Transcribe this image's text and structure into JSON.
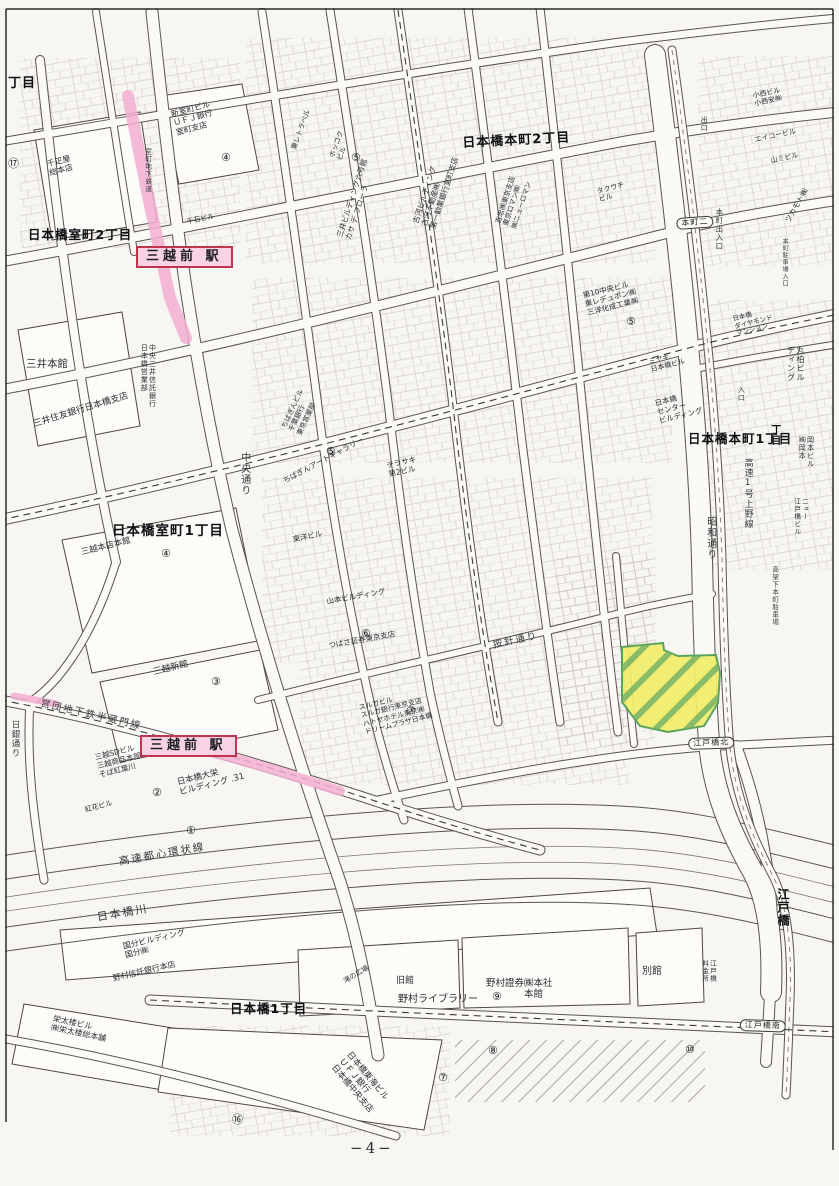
{
  "page": {
    "number": "−4−"
  },
  "colors": {
    "highlight_pink": "#f2aed2",
    "station_red": "#c2344d",
    "station_bg": "#f9d3e4",
    "parcel_fill": "#f2ee6a",
    "parcel_stroke": "#4e9e52",
    "parcel_hatch": "#6fae66"
  },
  "map": {
    "parcel": {
      "points": "622,647 663,643 664,650 678,656 716,655 720,673 718,703 704,726 668,732 640,726 622,702"
    },
    "pink_segments": [
      {
        "points": "128,96 148,196 170,298 186,338"
      },
      {
        "points": "204,750 268,768 340,791"
      },
      {
        "points": "14,696 56,704"
      }
    ],
    "labels": [
      {
        "name": "label-chome-fragment",
        "text": "丁目",
        "x": 8,
        "y": 76,
        "rot": 0,
        "fs": 13,
        "cls": "area"
      },
      {
        "name": "label-muromachi-2chome",
        "text": "日本橋室町2丁目",
        "x": 28,
        "y": 228,
        "rot": 0,
        "fs": 12.5,
        "cls": "area"
      },
      {
        "name": "label-honcho-2chome",
        "text": "日本橋本町2丁目",
        "x": 462,
        "y": 136,
        "rot": -3,
        "fs": 13,
        "cls": "area"
      },
      {
        "name": "label-muromachi-1chome",
        "text": "日本橋室町1丁目",
        "x": 112,
        "y": 524,
        "rot": 0,
        "fs": 13.5,
        "cls": "area"
      },
      {
        "name": "label-honcho-1chome",
        "text": "日本橋本町1丁目",
        "x": 688,
        "y": 432,
        "rot": 0,
        "fs": 12.5,
        "cls": "area"
      },
      {
        "name": "label-nihonbashi-1chome",
        "text": "日本橋1丁目",
        "x": 230,
        "y": 1002,
        "rot": 0,
        "fs": 12.5,
        "cls": "area"
      },
      {
        "name": "label-edobashi",
        "text": "江戸橋",
        "x": 776,
        "y": 888,
        "rot": 0,
        "fs": 12,
        "cls": "area vert"
      },
      {
        "name": "label-chome-right-edge",
        "text": "丁目",
        "x": 768,
        "y": 424,
        "rot": 0,
        "fs": 10,
        "cls": "area vert"
      },
      {
        "name": "station-box-mitsukoshimae-north",
        "text": "三越前 駅",
        "x": 136,
        "y": 246,
        "rot": 0,
        "fs": 13,
        "cls": "station"
      },
      {
        "name": "station-box-mitsukoshimae-south",
        "text": "三越前 駅",
        "x": 140,
        "y": 735,
        "rot": 0,
        "fs": 13,
        "cls": "station"
      },
      {
        "name": "road-label-chuo-dori",
        "text": "中央通り",
        "x": 238,
        "y": 452,
        "rot": 0,
        "fs": 10,
        "cls": "street vert"
      },
      {
        "name": "road-label-showa-dori",
        "text": "昭和通り",
        "x": 704,
        "y": 516,
        "rot": 0,
        "fs": 10,
        "cls": "street vert"
      },
      {
        "name": "road-label-kosoku-1-ueno",
        "text": "高速1号上野線",
        "x": 742,
        "y": 458,
        "rot": 0,
        "fs": 9,
        "cls": "street vert"
      },
      {
        "name": "road-label-kokashita-parking",
        "text": "高架下本町駐車場",
        "x": 770,
        "y": 566,
        "rot": 0,
        "fs": 6.5,
        "cls": "street vert"
      },
      {
        "name": "road-label-anjin-dori",
        "text": "按針通り",
        "x": 492,
        "y": 640,
        "rot": -12,
        "fs": 9.5,
        "cls": "street"
      },
      {
        "name": "road-label-hanzomon-line",
        "text": "営団地下鉄半蔵門線",
        "x": 42,
        "y": 698,
        "rot": 13,
        "fs": 9.5,
        "cls": "street"
      },
      {
        "name": "road-label-toshin-kanjo",
        "text": "高速都心環状線",
        "x": 118,
        "y": 856,
        "rot": -10,
        "fs": 10.5,
        "cls": "street"
      },
      {
        "name": "river-label-nihonbashigawa",
        "text": "日本橋川",
        "x": 96,
        "y": 912,
        "rot": -10,
        "fs": 11,
        "cls": "street"
      },
      {
        "name": "road-label-nichigin-dori",
        "text": "日銀通り",
        "x": 10,
        "y": 720,
        "rot": 0,
        "fs": 8.5,
        "cls": "street vert"
      },
      {
        "name": "road-label-honcho-deiriguchi",
        "text": "本町出入口",
        "x": 714,
        "y": 208,
        "rot": 0,
        "fs": 7.5,
        "cls": "street vert"
      },
      {
        "name": "road-label-honcho-parking-entrance",
        "text": "本町駐車場入口",
        "x": 781,
        "y": 238,
        "rot": 0,
        "fs": 6,
        "cls": "street vert"
      },
      {
        "name": "road-label-deguchi",
        "text": "出口",
        "x": 700,
        "y": 116,
        "rot": 0,
        "fs": 7,
        "cls": "street vert"
      },
      {
        "name": "road-label-iriguchi",
        "text": "入口",
        "x": 737,
        "y": 386,
        "rot": 0,
        "fs": 7,
        "cls": "street vert"
      },
      {
        "name": "road-label-muromachi-chika",
        "text": "室町地下鉄道",
        "x": 143,
        "y": 148,
        "rot": 0,
        "fs": 6.5,
        "cls": "street vert"
      },
      {
        "name": "oval-honcho-2",
        "text": "本町二",
        "x": 676,
        "y": 218,
        "rot": -4,
        "fs": 8,
        "cls": "oval"
      },
      {
        "name": "oval-edobashi-kita",
        "text": "江戸橋北",
        "x": 688,
        "y": 738,
        "rot": -2,
        "fs": 8,
        "cls": "oval"
      },
      {
        "name": "oval-edobashi-minami",
        "text": "江戸橋南",
        "x": 740,
        "y": 1019,
        "rot": 2,
        "fs": 8,
        "cls": "oval"
      },
      {
        "name": "bldg-shinmuromachi-ufj",
        "text": "新室町ビル\nＵＦＪ銀行\n室町支店",
        "x": 170,
        "y": 110,
        "rot": -15,
        "fs": 8,
        "cls": "bldg"
      },
      {
        "name": "bldg-sembikiya",
        "text": "千疋屋\n総本店",
        "x": 46,
        "y": 160,
        "rot": -15,
        "fs": 8,
        "cls": "bldg"
      },
      {
        "name": "bldg-sengoku",
        "text": "千石ビル",
        "x": 186,
        "y": 218,
        "rot": -12,
        "fs": 7,
        "cls": "bldg"
      },
      {
        "name": "bldg-hokkoku",
        "text": "ホッコク\nビル",
        "x": 328,
        "y": 156,
        "rot": -70,
        "fs": 7,
        "cls": "bldg"
      },
      {
        "name": "bldg-toray-travel",
        "text": "東レトラベル",
        "x": 290,
        "y": 148,
        "rot": -70,
        "fs": 7,
        "cls": "bldg"
      },
      {
        "name": "bldg-mitsui-6-casa",
        "text": "三井ビルディング六号館\nカサ デ フローラ",
        "x": 336,
        "y": 236,
        "rot": -72,
        "fs": 7.5,
        "cls": "bldg"
      },
      {
        "name": "bldg-furukawa",
        "text": "古河ビルディング\n古河不動産㈱\n第一勧業銀行室町支店",
        "x": 412,
        "y": 222,
        "rot": -72,
        "fs": 7.5,
        "cls": "bldg"
      },
      {
        "name": "bldg-yoshichu",
        "text": "吉忠㈱東京支店\n東京ロマン㈱\n㈱ニューロマン",
        "x": 494,
        "y": 222,
        "rot": -72,
        "fs": 7,
        "cls": "bldg"
      },
      {
        "name": "bldg-takeuchi",
        "text": "タクウチ\nビル",
        "x": 596,
        "y": 188,
        "rot": -15,
        "fs": 7,
        "cls": "bldg"
      },
      {
        "name": "bldg-konishi",
        "text": "小西ビル\n小西安㈱",
        "x": 752,
        "y": 92,
        "rot": -12,
        "fs": 7,
        "cls": "bldg"
      },
      {
        "name": "bldg-eiko",
        "text": "エイコービル",
        "x": 754,
        "y": 136,
        "rot": -12,
        "fs": 7,
        "cls": "bldg"
      },
      {
        "name": "bldg-yamami",
        "text": "山ミビル",
        "x": 770,
        "y": 157,
        "rot": -12,
        "fs": 7,
        "cls": "bldg"
      },
      {
        "name": "bldg-tsukamoto",
        "text": "ツカモト㈱",
        "x": 784,
        "y": 220,
        "rot": -60,
        "fs": 7.5,
        "cls": "bldg"
      },
      {
        "name": "bldg-mitsui-honkan",
        "text": "三井本館",
        "x": 26,
        "y": 358,
        "rot": 0,
        "fs": 10.5,
        "cls": "bldg"
      },
      {
        "name": "bldg-smbc-nihonbashi",
        "text": "三井住友銀行日本橋支店",
        "x": 32,
        "y": 420,
        "rot": -17,
        "fs": 9,
        "cls": "bldg"
      },
      {
        "name": "bldg-chuo-mitsui",
        "text": "中央三井信託銀行\n日本橋営業部",
        "x": 140,
        "y": 344,
        "rot": 0,
        "fs": 7,
        "cls": "bldg vert"
      },
      {
        "name": "bldg-chibagin",
        "text": "ちばぎんビル\n千葉銀行\n東京営業部",
        "x": 280,
        "y": 426,
        "rot": -65,
        "fs": 7,
        "cls": "bldg"
      },
      {
        "name": "bldg-chibagin-art",
        "text": "ちばぎんアートギャラリー",
        "x": 282,
        "y": 478,
        "rot": -28,
        "fs": 7.5,
        "cls": "bldg"
      },
      {
        "name": "bldg-terasaki",
        "text": "テラサキ\n第2ビル",
        "x": 386,
        "y": 462,
        "rot": -12,
        "fs": 7.5,
        "cls": "bldg"
      },
      {
        "name": "bldg-toyo",
        "text": "東洋ビル",
        "x": 292,
        "y": 536,
        "rot": -12,
        "fs": 7.5,
        "cls": "bldg"
      },
      {
        "name": "bldg-yamamoto",
        "text": "山本ビルディング",
        "x": 326,
        "y": 598,
        "rot": -10,
        "fs": 7.5,
        "cls": "bldg"
      },
      {
        "name": "bldg-tsubasa",
        "text": "つばさ証券東京支店",
        "x": 328,
        "y": 642,
        "rot": -10,
        "fs": 7.5,
        "cls": "bldg"
      },
      {
        "name": "bldg-mitsukoshi-honten",
        "text": "三越本店本館",
        "x": 80,
        "y": 548,
        "rot": -14,
        "fs": 8.5,
        "cls": "bldg"
      },
      {
        "name": "bldg-mitsukoshi-shinkan",
        "text": "三越新館",
        "x": 152,
        "y": 668,
        "rot": -14,
        "fs": 9,
        "cls": "bldg"
      },
      {
        "name": "bldg-suruga",
        "text": "スルガビル\nスルガ銀行東京支店\nハトヤホテル東京㈱\nドリームプラザ日本橋",
        "x": 358,
        "y": 704,
        "rot": -14,
        "fs": 7,
        "cls": "bldg"
      },
      {
        "name": "bldg-dai10-chuo",
        "text": "第10中央ビル\n東レデュポン㈱\n三洋化成工業㈱",
        "x": 582,
        "y": 292,
        "rot": -14,
        "fs": 7.5,
        "cls": "bldg"
      },
      {
        "name": "bldg-miyagi",
        "text": "ミヤギ\n日本橋ビル",
        "x": 648,
        "y": 358,
        "rot": -14,
        "fs": 7,
        "cls": "bldg"
      },
      {
        "name": "bldg-nihonbashi-center",
        "text": "日本橋\nセンター\nビルディング",
        "x": 654,
        "y": 400,
        "rot": -14,
        "fs": 7.5,
        "cls": "bldg"
      },
      {
        "name": "bldg-marukashiwa",
        "text": "丸柏ビル\nディング",
        "x": 786,
        "y": 346,
        "rot": 0,
        "fs": 8,
        "cls": "bldg vert"
      },
      {
        "name": "bldg-diamond-mansion",
        "text": "日本橋\nダイヤモンド\nマンション",
        "x": 732,
        "y": 316,
        "rot": -14,
        "fs": 6.5,
        "cls": "bldg"
      },
      {
        "name": "bldg-okamoto",
        "text": "岡本ビル\n㈱岡本",
        "x": 798,
        "y": 436,
        "rot": 0,
        "fs": 7,
        "cls": "bldg vert"
      },
      {
        "name": "bldg-new-edobashi",
        "text": "ニュー\n江戸橋ビル",
        "x": 792,
        "y": 498,
        "rot": 0,
        "fs": 6.5,
        "cls": "bldg vert"
      },
      {
        "name": "bldg-mitsukoshi-sd",
        "text": "三越SDビル\n三越商品本部\nそば紅葉川",
        "x": 94,
        "y": 754,
        "rot": -14,
        "fs": 7.5,
        "cls": "bldg"
      },
      {
        "name": "bldg-daiei",
        "text": "日本橋大栄\nビルディング .31",
        "x": 176,
        "y": 778,
        "rot": -14,
        "fs": 8.5,
        "cls": "bldg"
      },
      {
        "name": "bldg-benibana",
        "text": "紅花ビル",
        "x": 84,
        "y": 806,
        "rot": -14,
        "fs": 7,
        "cls": "bldg"
      },
      {
        "name": "bldg-kokubu",
        "text": "国分ビルディング\n国分㈱",
        "x": 122,
        "y": 942,
        "rot": -13,
        "fs": 8,
        "cls": "bldg"
      },
      {
        "name": "bldg-nomura-trust",
        "text": "野村信託銀行本店",
        "x": 112,
        "y": 974,
        "rot": -13,
        "fs": 8,
        "cls": "bldg"
      },
      {
        "name": "bldg-eitaro",
        "text": "栄太楼ビル\n㈱栄太楼総本舗",
        "x": 54,
        "y": 1014,
        "rot": 12,
        "fs": 8,
        "cls": "bldg"
      },
      {
        "name": "plaza-taki",
        "text": "滝の広場",
        "x": 342,
        "y": 978,
        "rot": -30,
        "fs": 7,
        "cls": "bldg"
      },
      {
        "name": "bldg-kyukan",
        "text": "旧館",
        "x": 396,
        "y": 976,
        "rot": 0,
        "fs": 9,
        "cls": "bldg"
      },
      {
        "name": "bldg-nomura-library",
        "text": "野村ライブラリー",
        "x": 398,
        "y": 994,
        "rot": 0,
        "fs": 10,
        "cls": "bldg"
      },
      {
        "name": "bldg-nomura-honsha",
        "text": "野村證券㈱本社\n　　　　本館",
        "x": 486,
        "y": 978,
        "rot": 0,
        "fs": 9.5,
        "cls": "bldg"
      },
      {
        "name": "bldg-bekkan",
        "text": "別館",
        "x": 642,
        "y": 966,
        "rot": 0,
        "fs": 10,
        "cls": "bldg"
      },
      {
        "name": "tollgate-edobashi",
        "text": "江戸橋\n料金所",
        "x": 700,
        "y": 960,
        "rot": 0,
        "fs": 6.5,
        "cls": "bldg vert"
      },
      {
        "name": "bldg-ufj-chuo-branch",
        "text": "日本橋東海ビル\nＵＦＪ銀行\n日本橋中央支店",
        "x": 352,
        "y": 1050,
        "rot": 50,
        "fs": 8.5,
        "cls": "bldg"
      },
      {
        "name": "circled-17",
        "text": "⑰",
        "x": 8,
        "y": 158,
        "rot": 0,
        "fs": 11,
        "cls": "circ"
      },
      {
        "name": "circled-4a",
        "text": "④",
        "x": 221,
        "y": 152,
        "rot": 0,
        "fs": 11,
        "cls": "circ"
      },
      {
        "name": "circled-5a",
        "text": "⑤",
        "x": 351,
        "y": 152,
        "rot": 0,
        "fs": 11,
        "cls": "circ"
      },
      {
        "name": "circled-4b",
        "text": "④",
        "x": 161,
        "y": 548,
        "rot": 0,
        "fs": 11,
        "cls": "circ"
      },
      {
        "name": "circled-3",
        "text": "③",
        "x": 211,
        "y": 676,
        "rot": 0,
        "fs": 11,
        "cls": "circ"
      },
      {
        "name": "circled-5b",
        "text": "⑤",
        "x": 326,
        "y": 446,
        "rot": 0,
        "fs": 11,
        "cls": "circ"
      },
      {
        "name": "circled-5c",
        "text": "⑤",
        "x": 626,
        "y": 316,
        "rot": 0,
        "fs": 11,
        "cls": "circ"
      },
      {
        "name": "circled-6",
        "text": "⑥",
        "x": 361,
        "y": 628,
        "rot": 0,
        "fs": 11,
        "cls": "circ"
      },
      {
        "name": "circled-7",
        "text": "⑦",
        "x": 406,
        "y": 705,
        "rot": 0,
        "fs": 11,
        "cls": "circ"
      },
      {
        "name": "circled-2",
        "text": "②",
        "x": 152,
        "y": 787,
        "rot": 0,
        "fs": 11,
        "cls": "circ"
      },
      {
        "name": "circled-1",
        "text": "①",
        "x": 186,
        "y": 825,
        "rot": 0,
        "fs": 11,
        "cls": "circ"
      },
      {
        "name": "circled-9",
        "text": "⑨",
        "x": 492,
        "y": 991,
        "rot": 0,
        "fs": 11,
        "cls": "circ"
      },
      {
        "name": "circled-8",
        "text": "⑧",
        "x": 488,
        "y": 1045,
        "rot": 0,
        "fs": 11,
        "cls": "circ"
      },
      {
        "name": "circled-7b",
        "text": "⑦",
        "x": 438,
        "y": 1072,
        "rot": 0,
        "fs": 11,
        "cls": "circ"
      },
      {
        "name": "circled-10",
        "text": "⑩",
        "x": 685,
        "y": 1044,
        "rot": 0,
        "fs": 11,
        "cls": "circ"
      },
      {
        "name": "circled-16",
        "text": "⑯",
        "x": 232,
        "y": 1114,
        "rot": 0,
        "fs": 11,
        "cls": "circ"
      },
      {
        "name": "page-number",
        "text": "−4−",
        "x": 350,
        "y": 1140,
        "rot": 0,
        "fs": 15,
        "cls": "pagefig"
      }
    ]
  }
}
